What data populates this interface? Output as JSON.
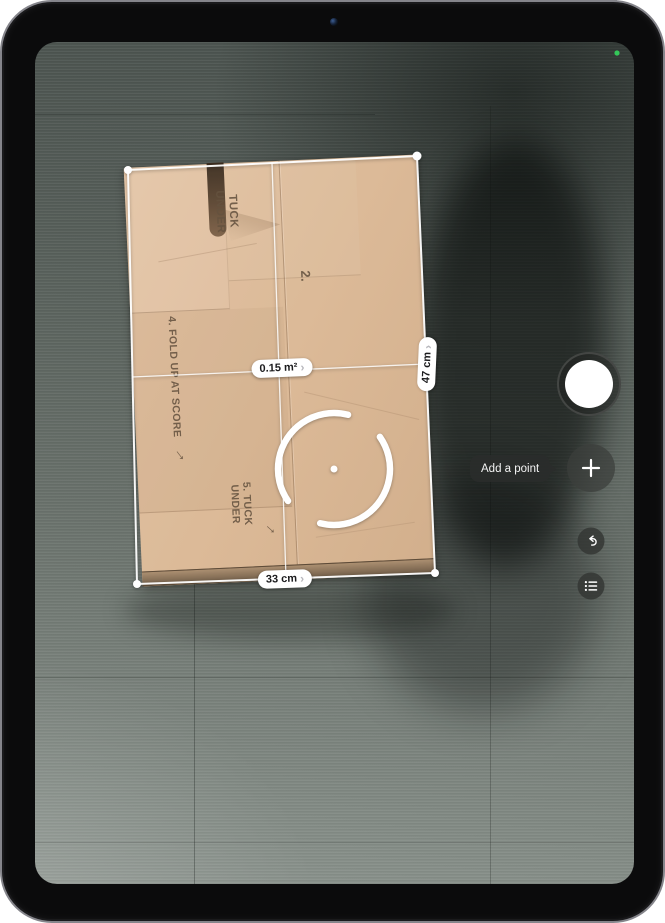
{
  "app": {
    "name": "Measure camera view"
  },
  "measurements": {
    "area": "0.15 m²",
    "right_edge": "47 cm",
    "bottom_edge": "33 cm",
    "chevron": "›"
  },
  "controls": {
    "add_point_tooltip": "Add a point"
  },
  "box_print": {
    "flap_lines": [
      "TUCK",
      "UNDER"
    ],
    "panel_number": "2.",
    "step4": "4. FOLD UP AT SCORE",
    "step5_lines": [
      "5. TUCK",
      "UNDER"
    ],
    "arrow": "→"
  },
  "status": {
    "camera_indicator_color": "#34C759"
  }
}
